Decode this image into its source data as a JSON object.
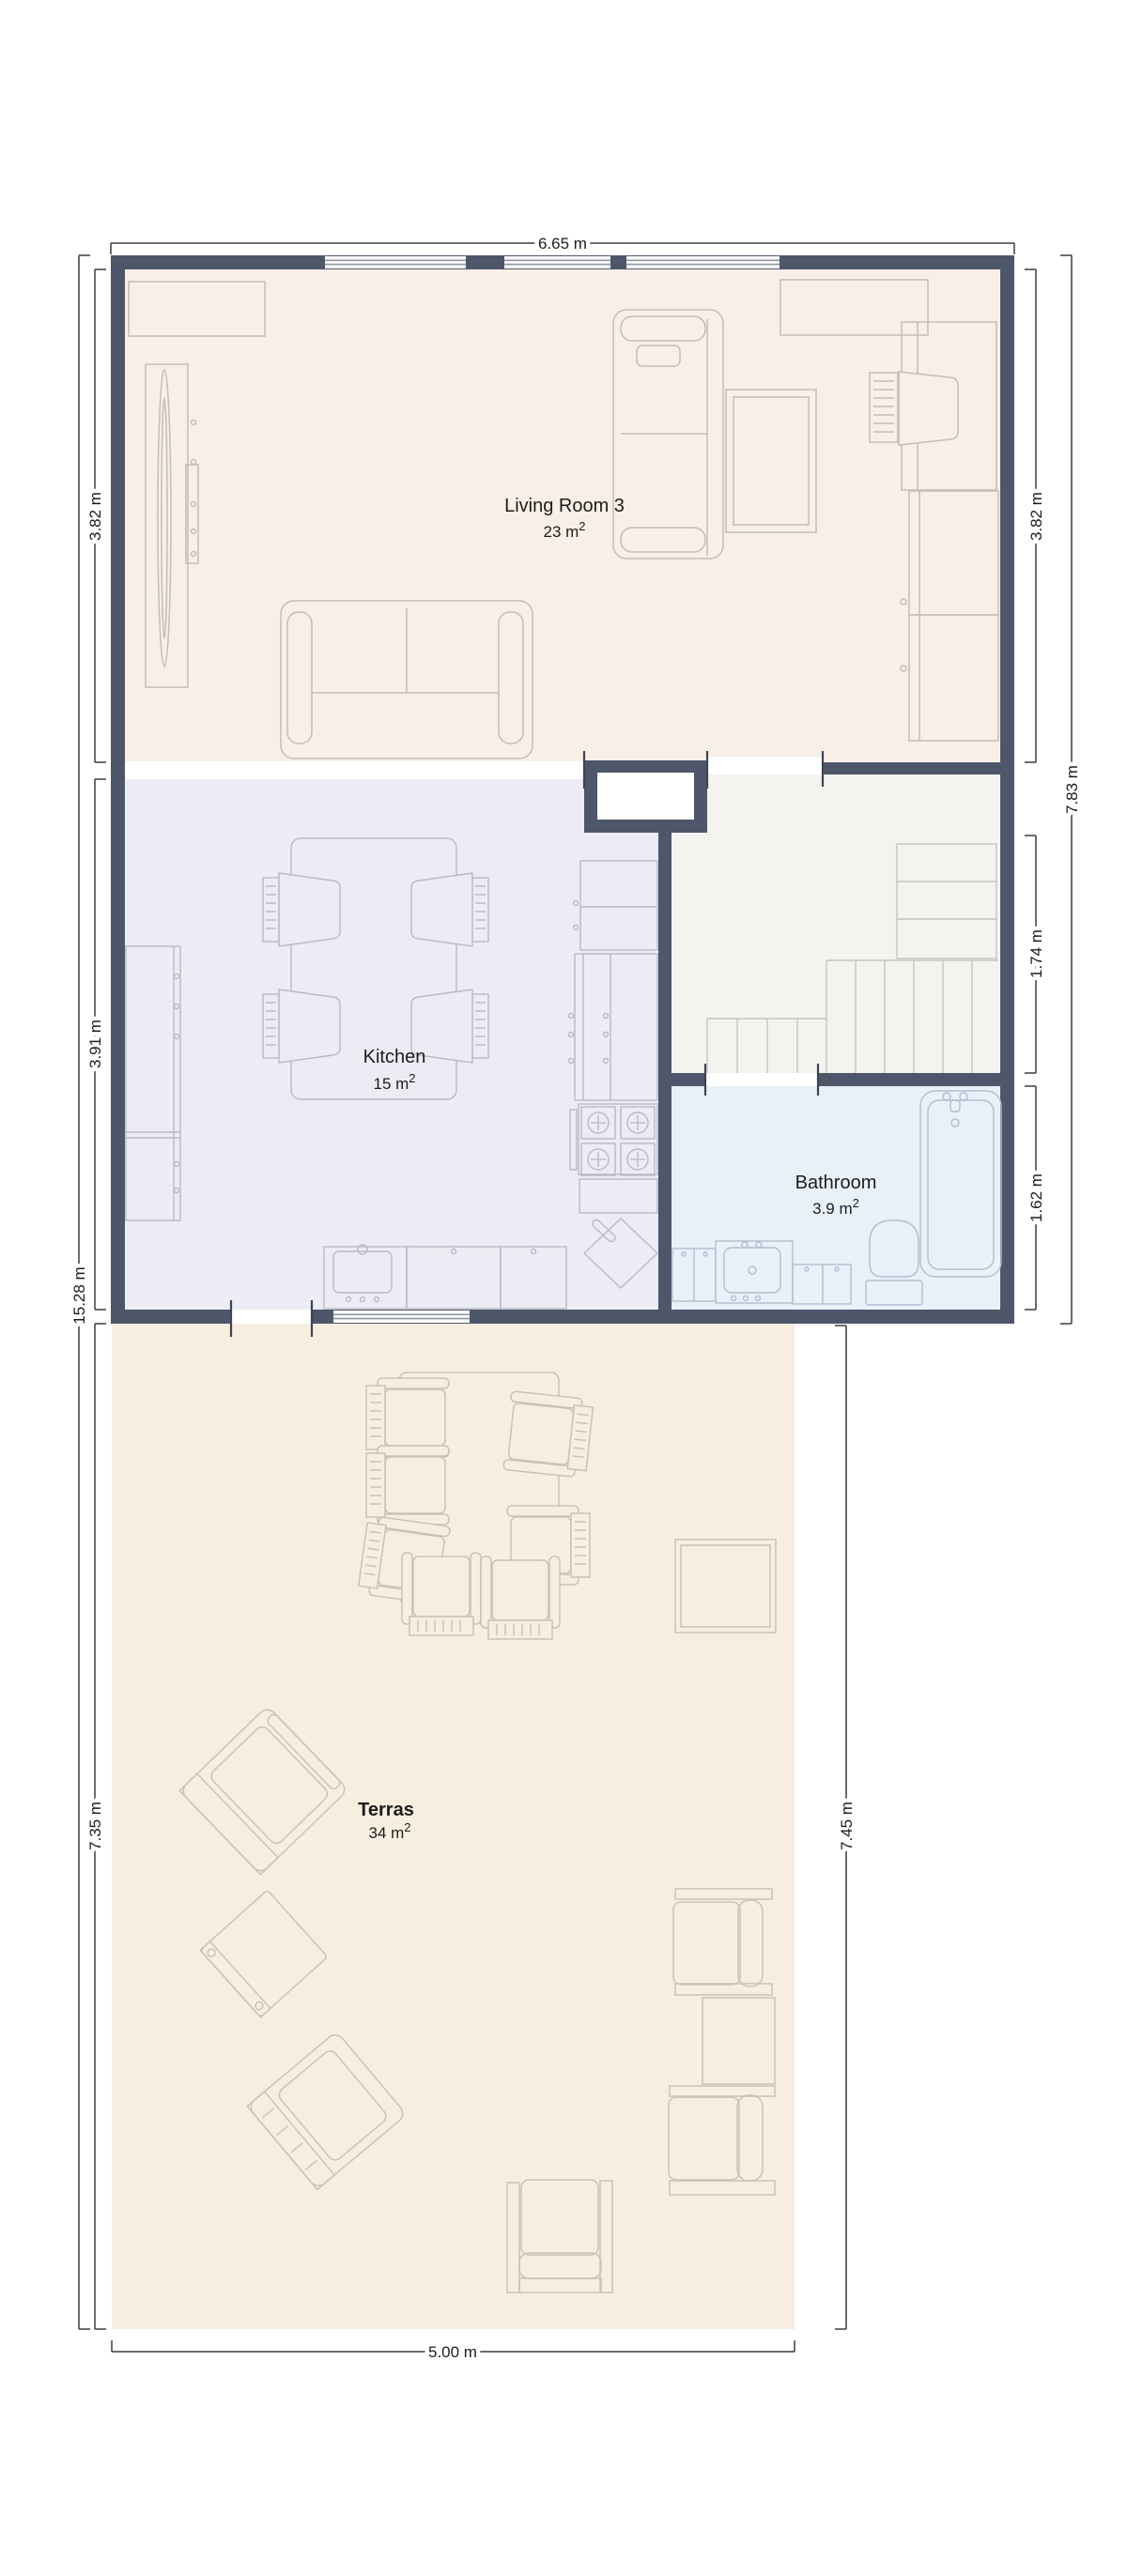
{
  "plan": {
    "type": "floor-plan",
    "rooms": {
      "living": {
        "name": "Living Room 3",
        "area": "23 m",
        "area_sup": "2"
      },
      "kitchen": {
        "name": "Kitchen",
        "area": "15 m",
        "area_sup": "2"
      },
      "bathroom": {
        "name": "Bathroom",
        "area": "3.9 m",
        "area_sup": "2"
      },
      "terrace": {
        "name": "Terras",
        "area": "34 m",
        "area_sup": "2"
      }
    },
    "dimensions": {
      "top_width": "6.65 m",
      "bottom_width": "5.00 m",
      "left_living": "3.82 m",
      "left_kitchen": "3.91 m",
      "left_terrace": "7.35 m",
      "left_total": "15.28 m",
      "right_living": "3.82 m",
      "right_building": "7.83 m",
      "right_hall": "1.74 m",
      "right_bathroom": "1.62 m",
      "right_terrace": "7.45 m"
    },
    "colors": {
      "wall": "#4e5669",
      "living_floor": "#f9efe6",
      "kitchen_floor": "#ececf4",
      "hall_floor": "#f4f3ef",
      "bathroom_floor": "#e8f0f8",
      "terrace_floor": "#f8eee0",
      "dimension_line": "#3c3c3c",
      "text": "#1c1c1c"
    }
  }
}
